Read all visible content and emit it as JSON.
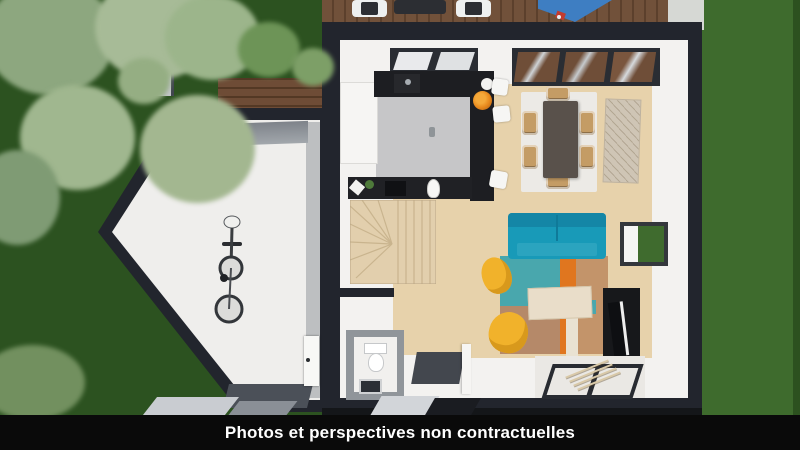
{
  "caption": {
    "text": "Photos et perspectives non contractuelles"
  },
  "scene": {
    "description": "3D aerial cutaway rendering of a house ground floor with garden, terrace and garage",
    "areas": [
      "garden",
      "terrace",
      "garage",
      "kitchen",
      "dining-area",
      "living-room",
      "staircase",
      "entrance-hall",
      "wc"
    ],
    "objects": [
      "trees",
      "wood-deck",
      "outdoor-chairs",
      "outdoor-table",
      "blue-shade-sail",
      "wood-fence",
      "path",
      "bicycle",
      "kitchen-counter",
      "bar-stools",
      "fruit-bowl",
      "kitchen-island",
      "dining-table",
      "dining-chairs",
      "sideboard",
      "glass-roof",
      "teal-sofa",
      "yellow-armchairs",
      "area-rug",
      "coffee-table",
      "tv-stand",
      "toilet",
      "doormats",
      "entry-glass-doors"
    ]
  },
  "colors": {
    "caption_bar": "#0a0a0a",
    "caption_text": "#ffffff",
    "walls": "#22252d",
    "interior_white": "#f3f2f0",
    "grass_left": "#2c5220",
    "grass_right": "#3e6b2d",
    "deck_wood": "#71513a",
    "floor_wood": "#e7d2ab",
    "kitchen_floor": "#c6c6c8",
    "counters_black": "#1d1e22",
    "sofa_teal": "#189ab8",
    "armchair_yellow": "#f1b22b",
    "rug_teal": "#49a7ad",
    "rug_orange": "#e0761f",
    "rug_tan": "#c3946a",
    "shade_blue": "#3e7ec2",
    "bowl_orange": "#e8891d"
  }
}
